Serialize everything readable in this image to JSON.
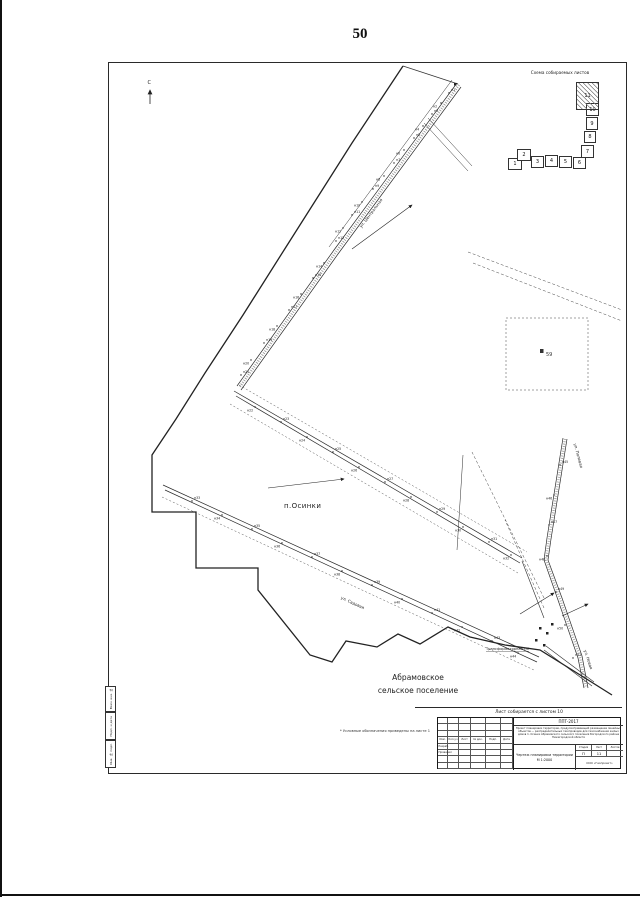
{
  "page": {
    "number": "50"
  },
  "scheme": {
    "title": "Схема собираемых листов",
    "current": "11",
    "sheets": [
      "1",
      "2",
      "3",
      "4",
      "5",
      "6",
      "7",
      "8",
      "9",
      "10",
      "11"
    ]
  },
  "compass": {
    "north_label": "С"
  },
  "map": {
    "settlement": "п.Осинки",
    "region_line1": "Абрамовское",
    "region_line2": "сельское поселение",
    "quarter_number": "59",
    "transformer_label": "Трансформаторная ПС",
    "streets": [
      {
        "name": "ул. Центральная",
        "x": 372,
        "y": 214,
        "rotate": -53
      },
      {
        "name": "ул. Садовая",
        "x": 352,
        "y": 604,
        "rotate": 25
      },
      {
        "name": "ул. Полевая",
        "x": 577,
        "y": 456,
        "rotate": 75
      },
      {
        "name": "ул. Новая",
        "x": 587,
        "y": 660,
        "rotate": 72
      }
    ],
    "points": [
      {
        "l": "н1",
        "x": 449,
        "y": 93
      },
      {
        "l": "н2",
        "x": 441,
        "y": 103
      },
      {
        "l": "н3",
        "x": 432,
        "y": 114
      },
      {
        "l": "н4",
        "x": 423,
        "y": 126
      },
      {
        "l": "н5",
        "x": 414,
        "y": 138
      },
      {
        "l": "н6",
        "x": 404,
        "y": 150
      },
      {
        "l": "н7",
        "x": 394,
        "y": 163
      },
      {
        "l": "н8",
        "x": 384,
        "y": 176
      },
      {
        "l": "н9",
        "x": 373,
        "y": 189
      },
      {
        "l": "н10",
        "x": 362,
        "y": 202
      },
      {
        "l": "н11",
        "x": 352,
        "y": 215
      },
      {
        "l": "н12",
        "x": 343,
        "y": 228
      },
      {
        "l": "н13",
        "x": 336,
        "y": 241
      },
      {
        "l": "н14",
        "x": 324,
        "y": 263
      },
      {
        "l": "н15",
        "x": 313,
        "y": 278
      },
      {
        "l": "н16",
        "x": 301,
        "y": 294
      },
      {
        "l": "н17",
        "x": 289,
        "y": 310
      },
      {
        "l": "н18",
        "x": 277,
        "y": 326
      },
      {
        "l": "н19",
        "x": 264,
        "y": 343
      },
      {
        "l": "н20",
        "x": 251,
        "y": 360
      },
      {
        "l": "н21",
        "x": 241,
        "y": 375
      },
      {
        "l": "н22",
        "x": 255,
        "y": 407
      },
      {
        "l": "н23",
        "x": 281,
        "y": 422
      },
      {
        "l": "н24",
        "x": 307,
        "y": 437
      },
      {
        "l": "н25",
        "x": 333,
        "y": 452
      },
      {
        "l": "н26",
        "x": 359,
        "y": 467
      },
      {
        "l": "н27",
        "x": 385,
        "y": 482
      },
      {
        "l": "н28",
        "x": 411,
        "y": 497
      },
      {
        "l": "н29",
        "x": 437,
        "y": 512
      },
      {
        "l": "н30",
        "x": 463,
        "y": 527
      },
      {
        "l": "н31",
        "x": 489,
        "y": 542
      },
      {
        "l": "н32",
        "x": 511,
        "y": 555
      },
      {
        "l": "н33",
        "x": 192,
        "y": 501
      },
      {
        "l": "н34",
        "x": 222,
        "y": 515
      },
      {
        "l": "н35",
        "x": 252,
        "y": 529
      },
      {
        "l": "н36",
        "x": 282,
        "y": 543
      },
      {
        "l": "н37",
        "x": 312,
        "y": 557
      },
      {
        "l": "н38",
        "x": 342,
        "y": 571
      },
      {
        "l": "н39",
        "x": 372,
        "y": 585
      },
      {
        "l": "н40",
        "x": 402,
        "y": 599
      },
      {
        "l": "н41",
        "x": 432,
        "y": 613
      },
      {
        "l": "н42",
        "x": 462,
        "y": 627
      },
      {
        "l": "н43",
        "x": 492,
        "y": 641
      },
      {
        "l": "н44",
        "x": 518,
        "y": 653
      },
      {
        "l": "н45",
        "x": 560,
        "y": 465
      },
      {
        "l": "н46",
        "x": 554,
        "y": 495
      },
      {
        "l": "н47",
        "x": 549,
        "y": 525
      },
      {
        "l": "н48",
        "x": 547,
        "y": 556
      },
      {
        "l": "н49",
        "x": 556,
        "y": 592
      },
      {
        "l": "н50",
        "x": 565,
        "y": 625
      },
      {
        "l": "н51",
        "x": 573,
        "y": 658
      }
    ]
  },
  "footnote": "* Условные обозначения приведены на листе 1",
  "stamp": {
    "assembly_note": "Лист собирается с листом 10",
    "doc_number": "ППТ-2017",
    "description": "Проект планировки территории, предусматривающий размещение линейных объектов — распределительных газопроводов для газоснабжения жилых домов п. Осинки Абрамовского сельского поселения Богородского района Нижегородской области",
    "sheet_title": "Чертеж планировки территории М 1:2000",
    "stage_label": "Стадия",
    "list_label": "Лист",
    "lists_label": "Листов",
    "stage_value": "П",
    "list_value": "11",
    "lists_value": "",
    "org": "ООО «Геопроект»",
    "header_cols": [
      "Изм.",
      "Кол.уч",
      "Лист",
      "№ док.",
      "Подп.",
      "Дата"
    ],
    "roles": [
      {
        "role": "Разраб.",
        "name": ""
      },
      {
        "role": "Проверил",
        "name": ""
      }
    ]
  },
  "side_strip": [
    "Взам. инв. №",
    "Подп. и дата",
    "Инв. № подл."
  ]
}
